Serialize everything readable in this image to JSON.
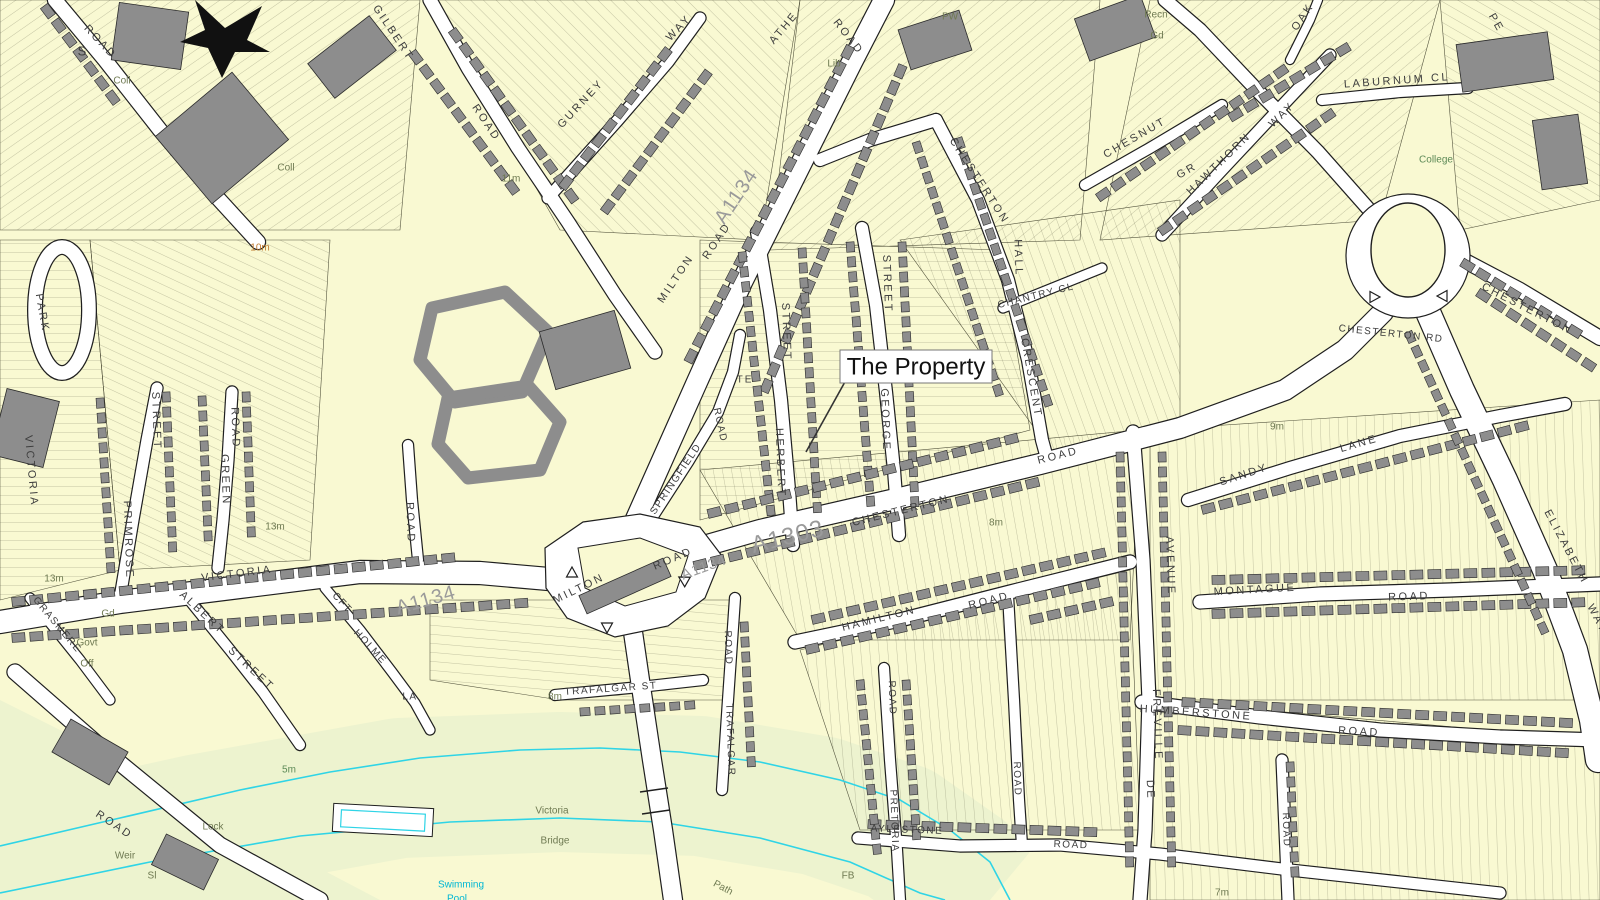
{
  "map": {
    "callout": {
      "text": "The Property"
    },
    "colors": {
      "paper": "#f9f9d2",
      "meadow": "#edf3cf",
      "road": "#ffffff",
      "line": "#1f1f1f",
      "building": "#8d8d8d",
      "buildingEdge": "#2a2a2a",
      "water": "#2fd4e6",
      "parcel": "#4f4f38",
      "street_text": "#3d3d3d",
      "feature_text": "#6f7a52",
      "road_number_text": "#9a9a9a",
      "water_text": "#00b7d4",
      "contour_text": "#c07a2e",
      "green_text": "#5d8a57"
    },
    "road_numbers": [
      "A1134",
      "A1303"
    ],
    "labels": [
      {
        "t": "ROAD",
        "x": 100,
        "y": 42,
        "r": 47
      },
      {
        "t": "GILBERT",
        "x": 393,
        "y": 33,
        "r": 56
      },
      {
        "t": "ROAD",
        "x": 486,
        "y": 123,
        "r": 56
      },
      {
        "t": "GURNEY",
        "x": 581,
        "y": 104,
        "r": -47
      },
      {
        "t": "WAY",
        "x": 679,
        "y": 28,
        "r": -47
      },
      {
        "t": "ATHE",
        "x": 784,
        "y": 28,
        "r": -50
      },
      {
        "t": "ROAD",
        "x": 848,
        "y": 37,
        "r": 52
      },
      {
        "t": "A1134",
        "x": 737,
        "y": 197,
        "r": -56,
        "s": 20,
        "c": "an",
        "sp": 1
      },
      {
        "t": "MILTON",
        "x": 676,
        "y": 279,
        "r": -56
      },
      {
        "t": "ROAD",
        "x": 717,
        "y": 241,
        "r": -56
      },
      {
        "t": "CHESTERTON",
        "x": 979,
        "y": 181,
        "r": 57
      },
      {
        "t": "HALL",
        "x": 1018,
        "y": 258,
        "r": 88
      },
      {
        "t": "CHANTRY CL",
        "x": 1036,
        "y": 296,
        "r": -14,
        "s": 10,
        "sp": 1.5
      },
      {
        "t": "CRESCENT",
        "x": 1031,
        "y": 378,
        "r": 80
      },
      {
        "t": "CHESNUT",
        "x": 1135,
        "y": 138,
        "r": -30
      },
      {
        "t": "GR",
        "x": 1187,
        "y": 171,
        "r": -30
      },
      {
        "t": "HAWTHORN",
        "x": 1219,
        "y": 164,
        "r": -44
      },
      {
        "t": "WAY",
        "x": 1282,
        "y": 115,
        "r": -44
      },
      {
        "t": "OAK",
        "x": 1303,
        "y": 17,
        "r": -56
      },
      {
        "t": "PE",
        "x": 1496,
        "y": 23,
        "r": 60
      },
      {
        "t": "LABURNUM CL",
        "x": 1397,
        "y": 81,
        "r": -4
      },
      {
        "t": "CHESTERTON",
        "x": 1527,
        "y": 309,
        "r": 27
      },
      {
        "t": "CHESTERTON RD",
        "x": 1391,
        "y": 334,
        "r": 6,
        "s": 10,
        "sp": 1.5
      },
      {
        "t": "STREET",
        "x": 786,
        "y": 332,
        "r": 88
      },
      {
        "t": "HERBERT",
        "x": 780,
        "y": 463,
        "r": 88
      },
      {
        "t": "STREET",
        "x": 887,
        "y": 284,
        "r": 88
      },
      {
        "t": "GEORGE",
        "x": 885,
        "y": 420,
        "r": 88
      },
      {
        "t": "TE",
        "x": 745,
        "y": 380,
        "s": 10,
        "sp": 2
      },
      {
        "t": "SPRINGFIELD",
        "x": 676,
        "y": 479,
        "r": -56,
        "s": 10,
        "sp": 1.5
      },
      {
        "t": "ROAD",
        "x": 720,
        "y": 425,
        "r": 78,
        "s": 10,
        "sp": 1.5
      },
      {
        "t": "MILTON",
        "x": 579,
        "y": 589,
        "r": -26
      },
      {
        "t": "ROAD",
        "x": 673,
        "y": 559,
        "r": -23
      },
      {
        "t": "A1134",
        "x": 704,
        "y": 568,
        "r": -20,
        "s": 15,
        "c": "an",
        "sp": 1
      },
      {
        "t": "A1303",
        "x": 788,
        "y": 538,
        "r": -14,
        "s": 24,
        "c": "an",
        "sp": 1
      },
      {
        "t": "A1134",
        "x": 426,
        "y": 601,
        "r": -16,
        "s": 20,
        "c": "an",
        "sp": 1
      },
      {
        "t": "CHESTERTON",
        "x": 901,
        "y": 511,
        "r": -14
      },
      {
        "t": "ROAD",
        "x": 1058,
        "y": 456,
        "r": -14
      },
      {
        "t": "HAMILTON",
        "x": 879,
        "y": 619,
        "r": -14
      },
      {
        "t": "ROAD",
        "x": 989,
        "y": 601,
        "r": -14
      },
      {
        "t": "AVENUE",
        "x": 1170,
        "y": 566,
        "r": 88
      },
      {
        "t": "FREVILLE",
        "x": 1157,
        "y": 725,
        "r": 88
      },
      {
        "t": "DE",
        "x": 1150,
        "y": 790,
        "r": 88
      },
      {
        "t": "SANDY",
        "x": 1244,
        "y": 475,
        "r": -18
      },
      {
        "t": "LANE",
        "x": 1359,
        "y": 444,
        "r": -16
      },
      {
        "t": "MONTAGUE",
        "x": 1255,
        "y": 590,
        "r": -3
      },
      {
        "t": "ROAD",
        "x": 1409,
        "y": 597,
        "r": -2
      },
      {
        "t": "HUMBERSTONE",
        "x": 1196,
        "y": 713,
        "r": 4
      },
      {
        "t": "ROAD",
        "x": 1359,
        "y": 732,
        "r": 3
      },
      {
        "t": "ELIZABETH",
        "x": 1566,
        "y": 547,
        "r": 62
      },
      {
        "t": "WAY",
        "x": 1597,
        "y": 619,
        "r": 62
      },
      {
        "t": "VICTORIA",
        "x": 237,
        "y": 574,
        "r": -7
      },
      {
        "t": "ROAD",
        "x": 410,
        "y": 523,
        "r": 88
      },
      {
        "t": "STREET",
        "x": 156,
        "y": 421,
        "r": 88
      },
      {
        "t": "PRIMROSE",
        "x": 128,
        "y": 540,
        "r": 88
      },
      {
        "t": "ROAD",
        "x": 235,
        "y": 428,
        "r": 88
      },
      {
        "t": "GREEN",
        "x": 225,
        "y": 480,
        "r": 88
      },
      {
        "t": "ALBERT",
        "x": 202,
        "y": 613,
        "r": 43
      },
      {
        "t": "STREET",
        "x": 251,
        "y": 669,
        "r": 43
      },
      {
        "t": "PARK",
        "x": 42,
        "y": 313,
        "r": 80
      },
      {
        "t": "VICTORIA",
        "x": 31,
        "y": 471,
        "r": 85
      },
      {
        "t": "GRASMERE",
        "x": 57,
        "y": 625,
        "r": 50,
        "s": 10,
        "sp": 1.5
      },
      {
        "t": "CFT",
        "x": 342,
        "y": 603,
        "r": 47,
        "s": 10,
        "sp": 1.5
      },
      {
        "t": "HOLME",
        "x": 370,
        "y": 647,
        "r": 47,
        "s": 10,
        "sp": 1.5
      },
      {
        "t": "LA",
        "x": 410,
        "y": 697,
        "s": 10,
        "sp": 1.5
      },
      {
        "t": "ROAD",
        "x": 114,
        "y": 825,
        "r": 34
      },
      {
        "t": "TRAFALGAR ST",
        "x": 611,
        "y": 689,
        "r": -4,
        "s": 10,
        "sp": 1.5
      },
      {
        "t": "ROAD",
        "x": 728,
        "y": 648,
        "r": 88,
        "s": 10,
        "sp": 1.5
      },
      {
        "t": "TRAFALGAR",
        "x": 730,
        "y": 740,
        "r": 88,
        "s": 10,
        "sp": 1.5
      },
      {
        "t": "ROAD",
        "x": 892,
        "y": 698,
        "r": 88,
        "s": 10,
        "sp": 1.5
      },
      {
        "t": "PRETORIA",
        "x": 894,
        "y": 821,
        "r": 88,
        "s": 10,
        "sp": 1.5
      },
      {
        "t": "AYLESTONE",
        "x": 907,
        "y": 830,
        "r": 2,
        "s": 10,
        "sp": 1.5
      },
      {
        "t": "ROAD",
        "x": 1071,
        "y": 845,
        "r": 2,
        "s": 10,
        "sp": 1.5
      },
      {
        "t": "ROAD",
        "x": 1286,
        "y": 830,
        "r": 88,
        "s": 10,
        "sp": 1.5
      },
      {
        "t": "ROAD",
        "x": 1017,
        "y": 779,
        "r": 88,
        "s": 10,
        "sp": 1.5
      },
      {
        "t": "S",
        "x": 82,
        "y": 52,
        "s": 13,
        "sp": 0
      },
      {
        "t": "Coll",
        "x": 122,
        "y": 81,
        "c": "ft"
      },
      {
        "t": "Coll",
        "x": 286,
        "y": 168,
        "c": "ft"
      },
      {
        "t": "Lib",
        "x": 834,
        "y": 64,
        "c": "ft"
      },
      {
        "t": "PW",
        "x": 950,
        "y": 17,
        "c": "ft"
      },
      {
        "t": "Recn",
        "x": 1156,
        "y": 15,
        "c": "ft"
      },
      {
        "t": "Gd",
        "x": 1157,
        "y": 36,
        "c": "ft"
      },
      {
        "t": "College",
        "x": 1436,
        "y": 160,
        "c": "gr"
      },
      {
        "t": "Govt",
        "x": 87,
        "y": 643,
        "c": "ft"
      },
      {
        "t": "Off",
        "x": 87,
        "y": 664,
        "c": "ft"
      },
      {
        "t": "Gd",
        "x": 108,
        "y": 614,
        "c": "ft"
      },
      {
        "t": "Lock",
        "x": 213,
        "y": 827,
        "c": "ft"
      },
      {
        "t": "Weir",
        "x": 125,
        "y": 856,
        "c": "ft"
      },
      {
        "t": "Sl",
        "x": 152,
        "y": 876,
        "c": "ft"
      },
      {
        "t": "FB",
        "x": 848,
        "y": 876,
        "c": "ft"
      },
      {
        "t": "Path",
        "x": 723,
        "y": 888,
        "r": 28,
        "c": "ft"
      },
      {
        "t": "Victoria",
        "x": 552,
        "y": 811,
        "c": "ft"
      },
      {
        "t": "Bridge",
        "x": 555,
        "y": 841,
        "c": "ft"
      },
      {
        "t": "Swimming",
        "x": 461,
        "y": 885,
        "c": "wa"
      },
      {
        "t": "Pool",
        "x": 457,
        "y": 899,
        "c": "wa"
      },
      {
        "t": "11m",
        "x": 511,
        "y": 179,
        "c": "ft"
      },
      {
        "t": "10m",
        "x": 260,
        "y": 248,
        "c": "co"
      },
      {
        "t": "13m",
        "x": 275,
        "y": 527,
        "c": "ft"
      },
      {
        "t": "13m",
        "x": 54,
        "y": 579,
        "c": "ft"
      },
      {
        "t": "8m",
        "x": 996,
        "y": 523,
        "c": "ft"
      },
      {
        "t": "8m",
        "x": 555,
        "y": 697,
        "c": "ft"
      },
      {
        "t": "9m",
        "x": 1277,
        "y": 427,
        "c": "ft"
      },
      {
        "t": "7m",
        "x": 1222,
        "y": 893,
        "c": "ft"
      },
      {
        "t": "5m",
        "x": 289,
        "y": 770,
        "c": "gr"
      }
    ]
  }
}
